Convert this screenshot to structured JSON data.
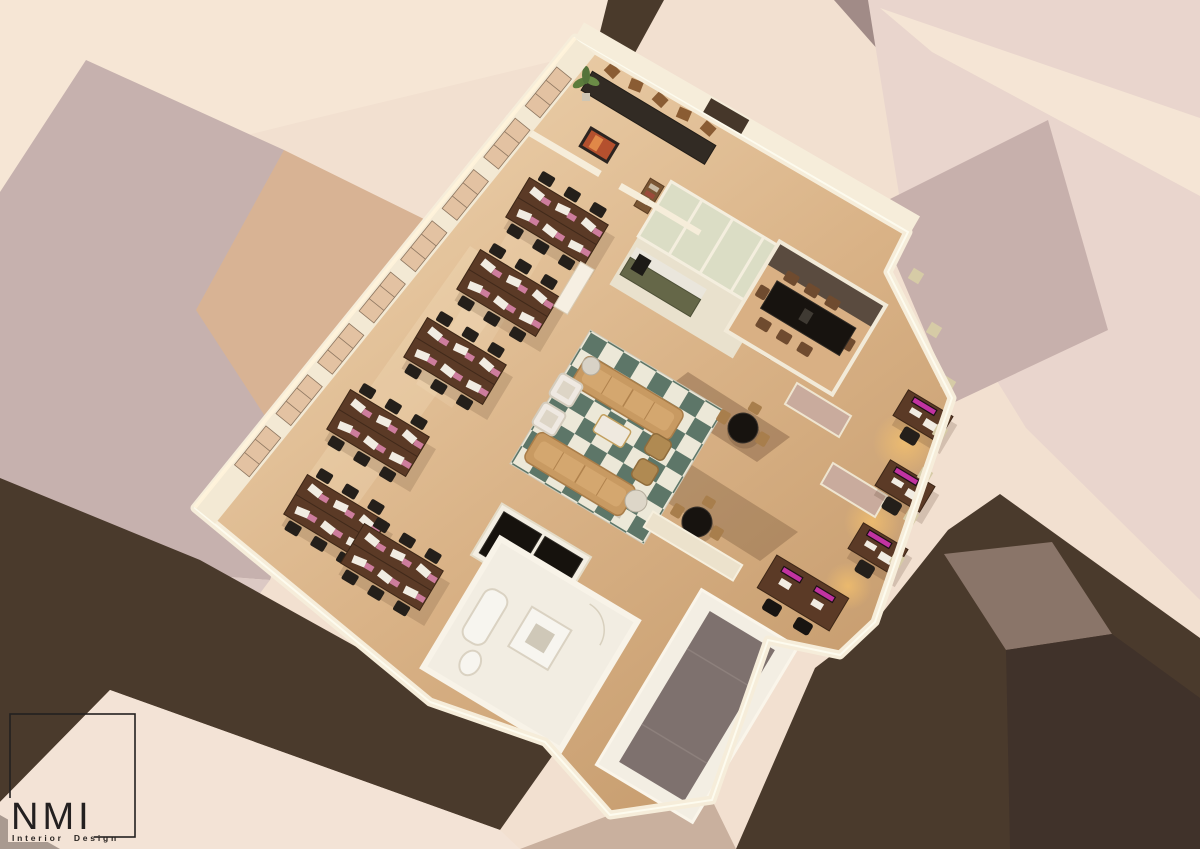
{
  "brand": {
    "name": "NMI",
    "tagline": "Interior Design"
  },
  "scene": {
    "type": "3d-interior-render",
    "view": "aerial-axonometric-cutaway-floor-plan",
    "areas": [
      {
        "id": "reception-bar",
        "name": "reception bar with stools, artwork and plant"
      },
      {
        "id": "training-area",
        "name": "open training area with six desk clusters"
      },
      {
        "id": "lounge",
        "name": "lounge with checkered rug, two sofas and armchairs"
      },
      {
        "id": "kitchenette",
        "name": "kitchenette with olive cabinets and glass booths"
      },
      {
        "id": "conference-room",
        "name": "conference room with long dark table"
      },
      {
        "id": "private-offices",
        "name": "office wing with workstations and glowing monitors"
      },
      {
        "id": "cafe-tables",
        "name": "round cafe tables"
      },
      {
        "id": "bathroom",
        "name": "bathroom with white fixtures"
      },
      {
        "id": "wardrobe",
        "name": "dark wardrobe closet"
      },
      {
        "id": "entry-landing",
        "name": "entry landing with grey mat"
      }
    ],
    "palette": {
      "backdrop_cream": "#f2e0d0",
      "mass_mauve": "#c6b1ae",
      "mass_tan": "#d8b394",
      "mass_pink": "#e9d5cd",
      "street_dark": "#4a3a2c",
      "slab_grey": "#8a7569",
      "wall_cream": "#f6edda",
      "window_tan": "#e3c2a2",
      "floor_wood": "#d9b286",
      "rug_green": "#5d7668",
      "rug_cream": "#ece8d8",
      "sofa_tan": "#c89a62",
      "desk_brown": "#5b3a26",
      "chair_dark": "#241f1a",
      "table_black": "#17130f",
      "monitor_magenta": "#c133a1",
      "cabinet_olive": "#656748",
      "logo_ink": "#232020"
    }
  }
}
